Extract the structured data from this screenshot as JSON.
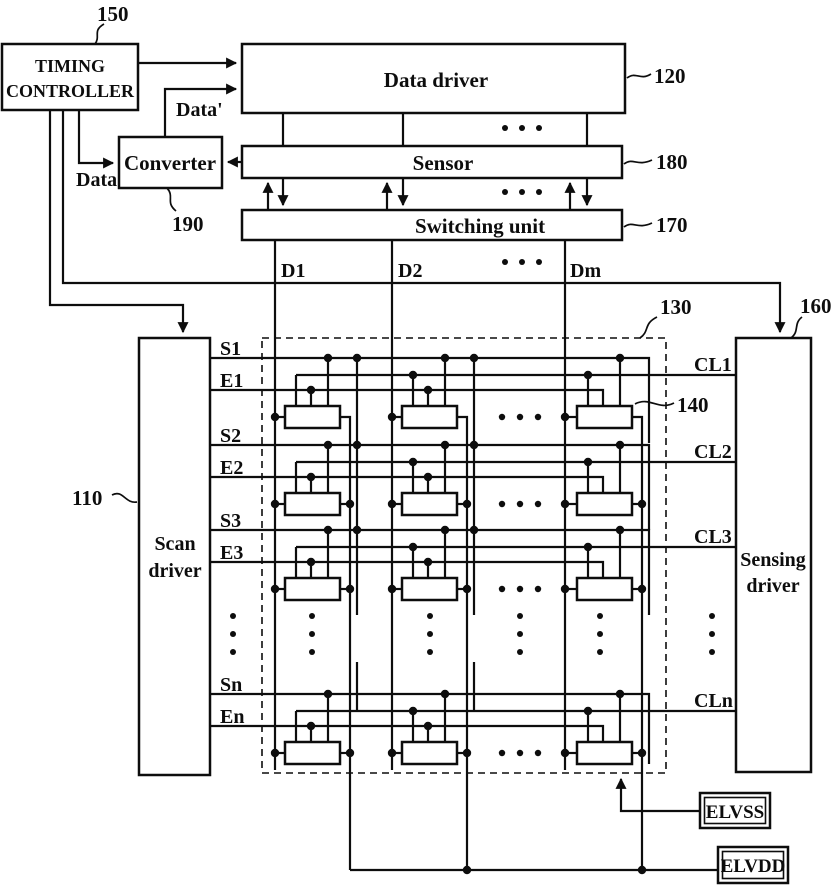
{
  "colors": {
    "ink": "#0d0d0d",
    "background": "#ffffff"
  },
  "blocks": {
    "timing_controller": {
      "line1": "TIMING",
      "line2": "CONTROLLER",
      "ref": "150"
    },
    "data_driver": {
      "label": "Data driver",
      "ref": "120"
    },
    "converter": {
      "label": "Converter",
      "ref": "190"
    },
    "sensor": {
      "label": "Sensor",
      "ref": "180"
    },
    "switching_unit": {
      "label": "Switching unit",
      "ref": "170"
    },
    "scan_driver": {
      "line1": "Scan",
      "line2": "driver",
      "ref": "110"
    },
    "sensing_driver": {
      "line1": "Sensing",
      "line2": "driver",
      "ref": "160"
    },
    "pixel_array": {
      "ref": "130"
    },
    "pixel": {
      "ref": "140"
    },
    "elvss": {
      "label": "ELVSS"
    },
    "elvdd": {
      "label": "ELVDD"
    }
  },
  "signals": {
    "data": "Data",
    "data_prime": "Data'",
    "data_lines": [
      "D1",
      "D2",
      "Dm"
    ],
    "scan_lines": [
      "S1",
      "S2",
      "S3",
      "Sn"
    ],
    "emission_lines": [
      "E1",
      "E2",
      "E3",
      "En"
    ],
    "sensing_lines": [
      "CL1",
      "CL2",
      "CL3",
      "CLn"
    ]
  }
}
